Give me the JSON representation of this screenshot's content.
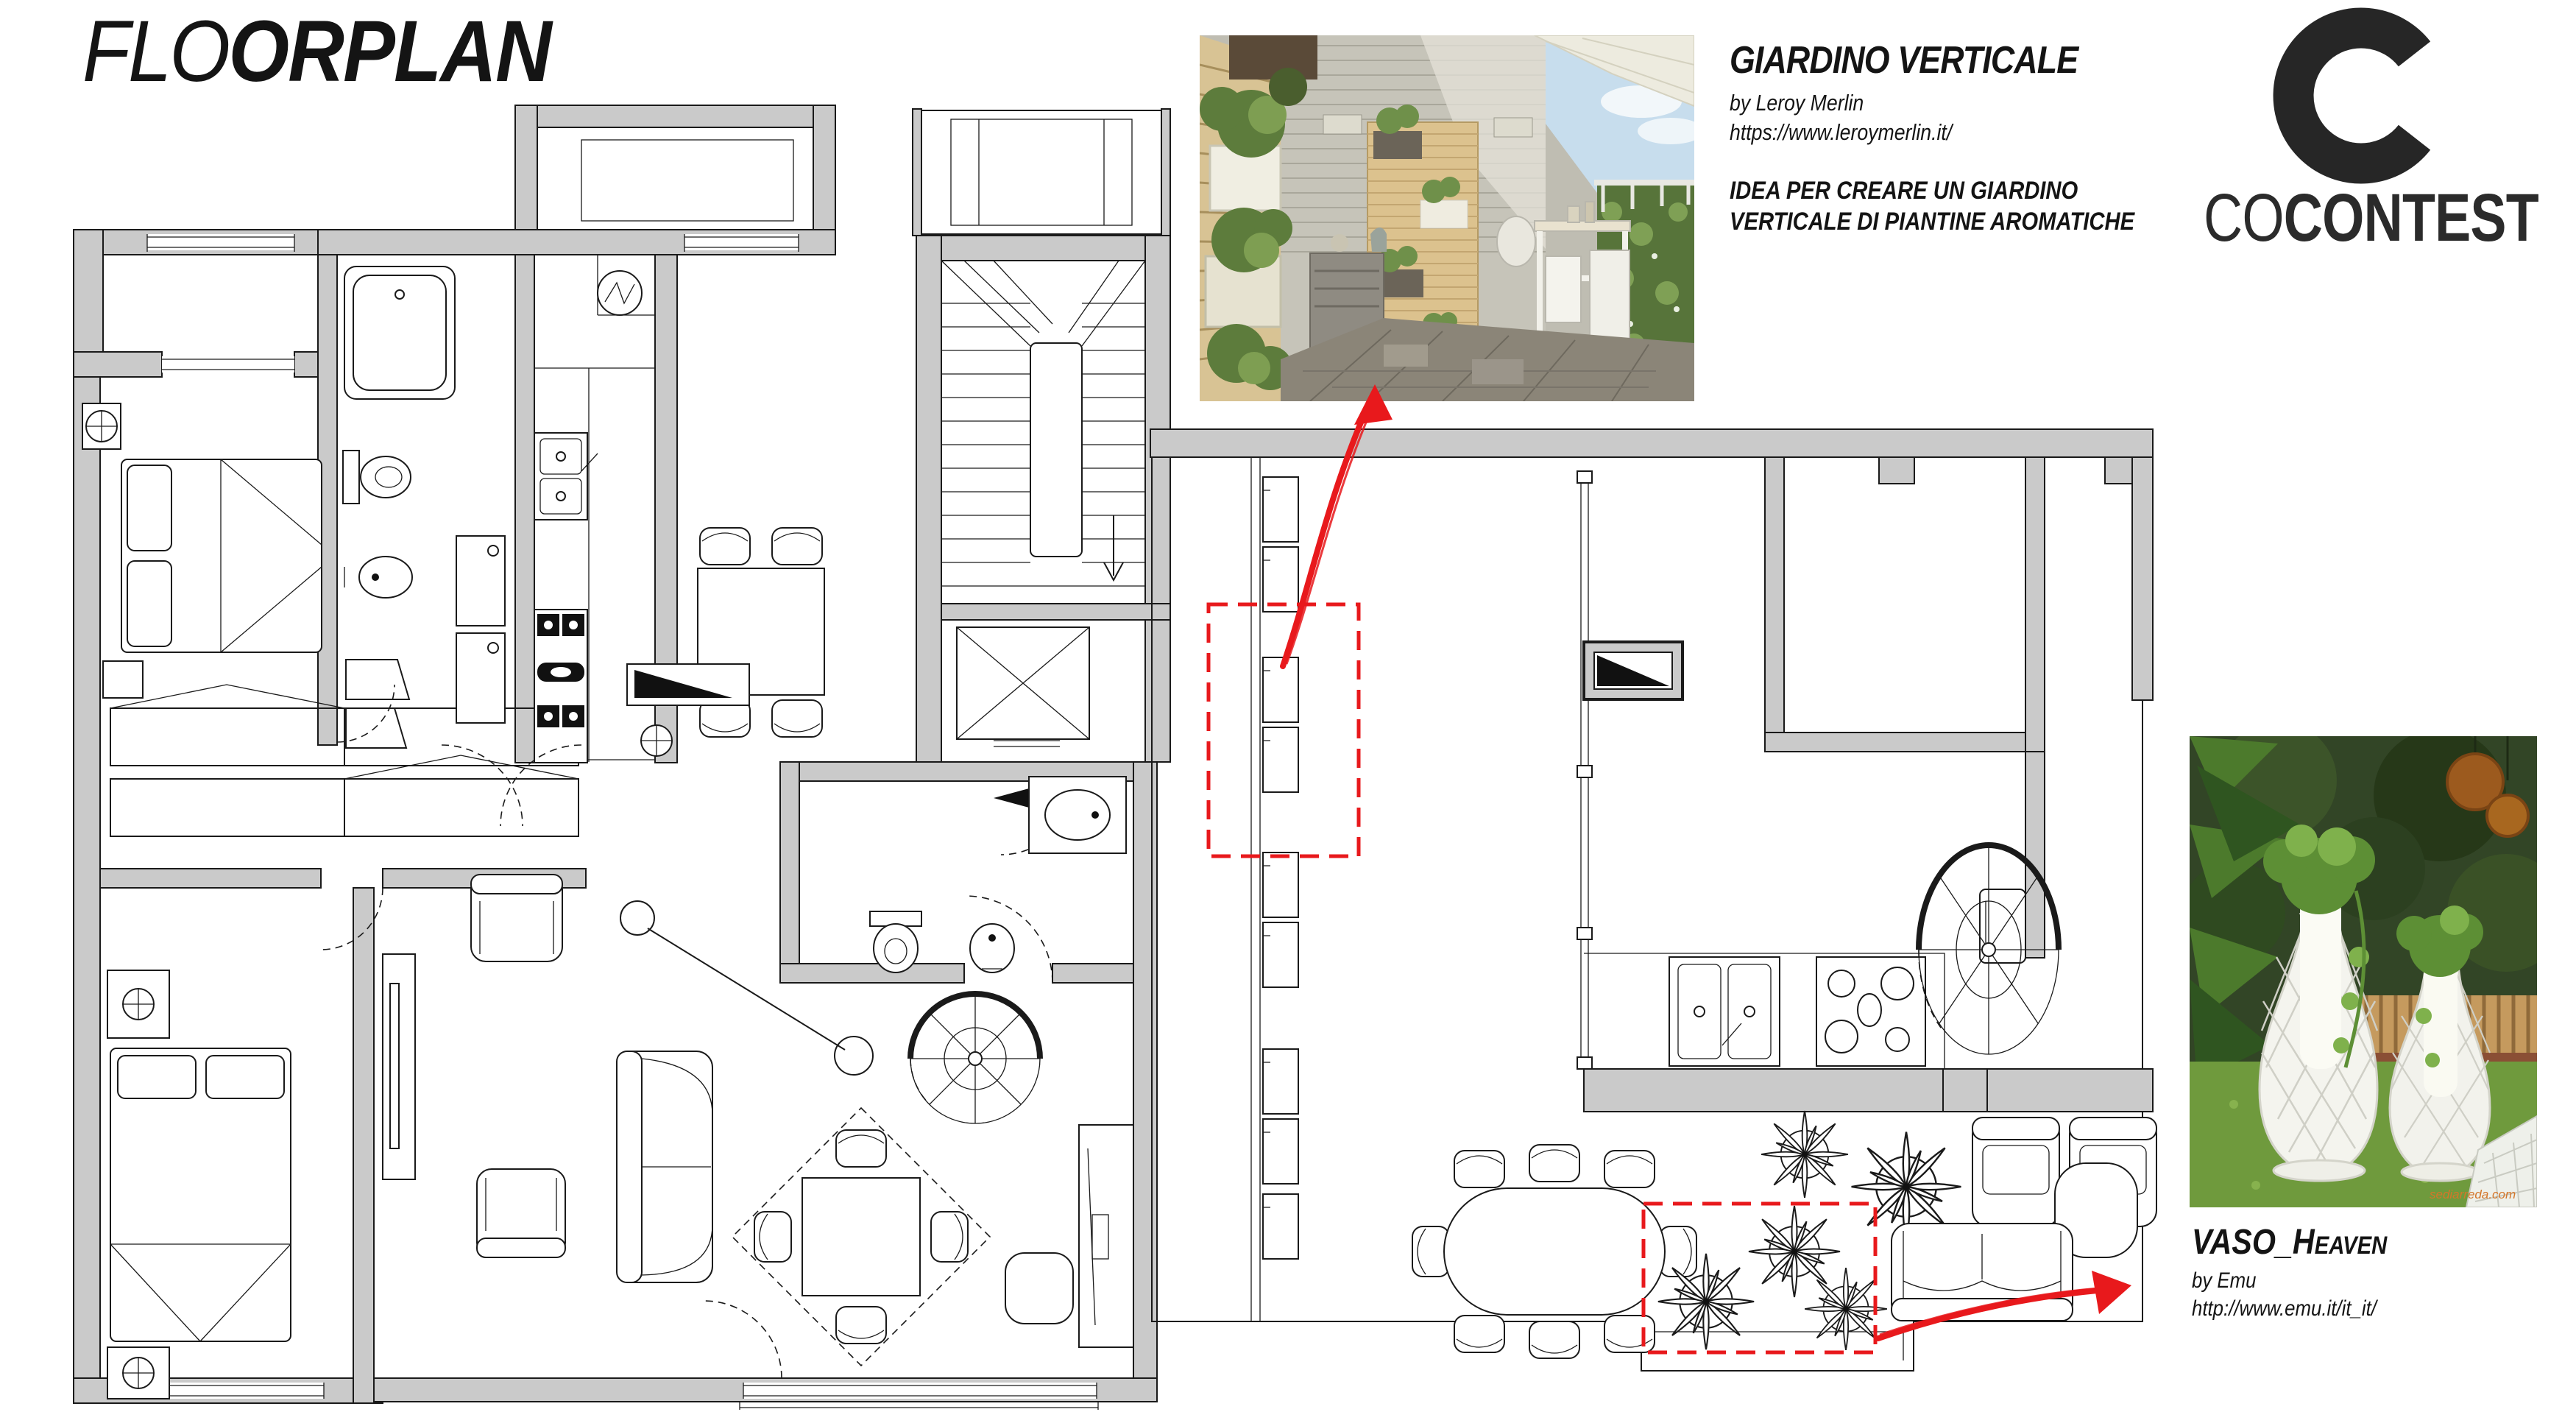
{
  "header": {
    "title_light": "FLO",
    "title_bold": "ORPLAN"
  },
  "logo": {
    "letter": "C",
    "word_light": "CO",
    "word_bold": "CONTEST"
  },
  "annotations": {
    "giardino": {
      "title": "GIARDINO VERTICALE",
      "byline": "by Leroy Merlin",
      "url": "https://www.leroymerlin.it/",
      "desc_line1": "IDEA PER CREARE UN GIARDINO",
      "desc_line2": "VERTICALE DI PIANTINE AROMATICHE"
    },
    "vaso": {
      "title_main": "VASO_H",
      "title_caps": "EAVEN",
      "byline": "by Emu",
      "url": "http://www.emu.it/it_it/"
    },
    "watermark": "sediarreda.com"
  },
  "colors": {
    "accent_red": "#E8191C",
    "wall_gray": "#CACACA",
    "line_black": "#1A1A1A"
  }
}
